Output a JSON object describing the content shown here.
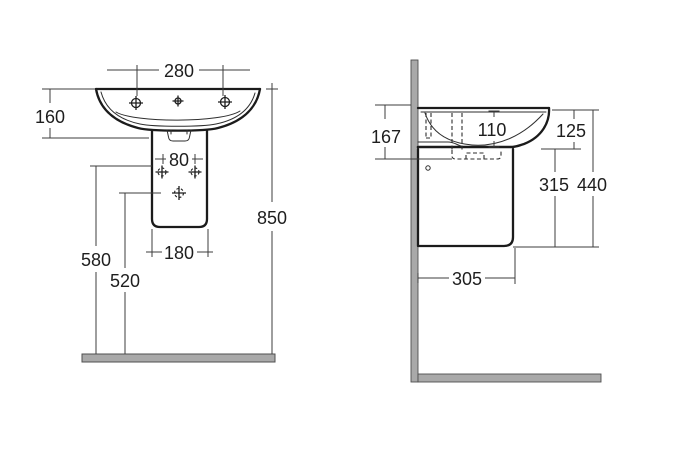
{
  "front_view": {
    "tap_hole_spacing": "280",
    "rim_to_basin_bottom": "160",
    "pedestal_fixing_spacing": "80",
    "pedestal_width": "180",
    "overall_height": "850",
    "upper_fixing_height": "580",
    "lower_fixing_height": "520"
  },
  "side_view": {
    "fixing_zone_height": "167",
    "bowl_inner_depth": "110",
    "rim_to_underside": "125",
    "underside_to_semipedestal": "315",
    "rim_to_semipedestal": "440",
    "semipedestal_depth": "305"
  },
  "colors": {
    "masonry": "#a9a9a9",
    "masonry_edge": "#4f4f4f"
  }
}
